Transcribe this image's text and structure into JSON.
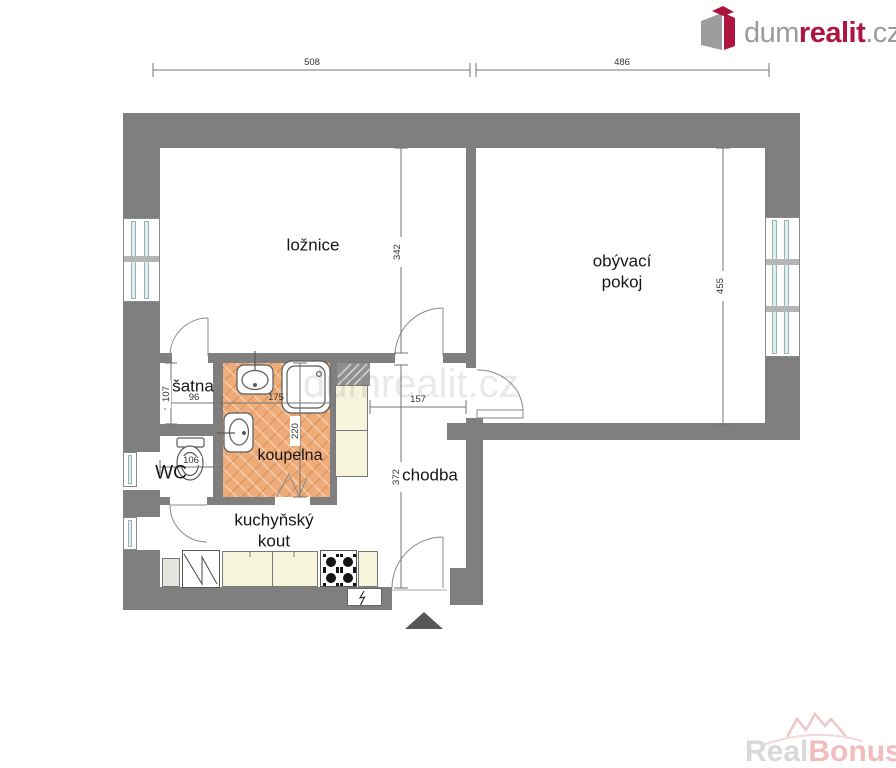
{
  "header": {
    "logo": {
      "dum": "dum",
      "realit": "realit",
      "cz": ".cz"
    }
  },
  "floorplan": {
    "rooms": {
      "loznice": {
        "label": "ložnice"
      },
      "obyvaci_pokoj": {
        "line1": "obývací",
        "line2": "pokoj"
      },
      "satna": {
        "label": "šatna"
      },
      "wc": {
        "label": "WC"
      },
      "koupelna": {
        "label": "koupelna"
      },
      "chodba": {
        "label": "chodba"
      },
      "kuchynsky_kout": {
        "line1": "kuchyňský",
        "line2": "kout"
      }
    },
    "dimensions": {
      "top_left": "508",
      "top_right": "486",
      "loznice_depth": "342",
      "obyvaci_depth": "455",
      "satna_depth": "107",
      "satna_width": "96",
      "koupelna_width": "175",
      "koupelna_depth": "220",
      "wc_width": "106",
      "chodba_width": "157",
      "chodba_depth": "372"
    },
    "icons": {
      "entrance_marker": "filled-triangle-up",
      "stove": "four-burner-cooktop",
      "bathroom": [
        "sink",
        "bathtub",
        "sink",
        "toilet"
      ]
    },
    "colors": {
      "wall": "#7f7f7f",
      "bath_floor": "#efac78",
      "cabinet_fill": "#f6f5dc",
      "window_glass": "#dceff1",
      "entrance_marker": "#575757",
      "brand_red": "#ae1440",
      "watermark_pink": "#f2bcbc"
    }
  },
  "watermarks": {
    "center": "dumrealit.cz",
    "bottom_right": {
      "real": "Real",
      "bonus": "Bonus",
      "cz": ".cz"
    }
  }
}
